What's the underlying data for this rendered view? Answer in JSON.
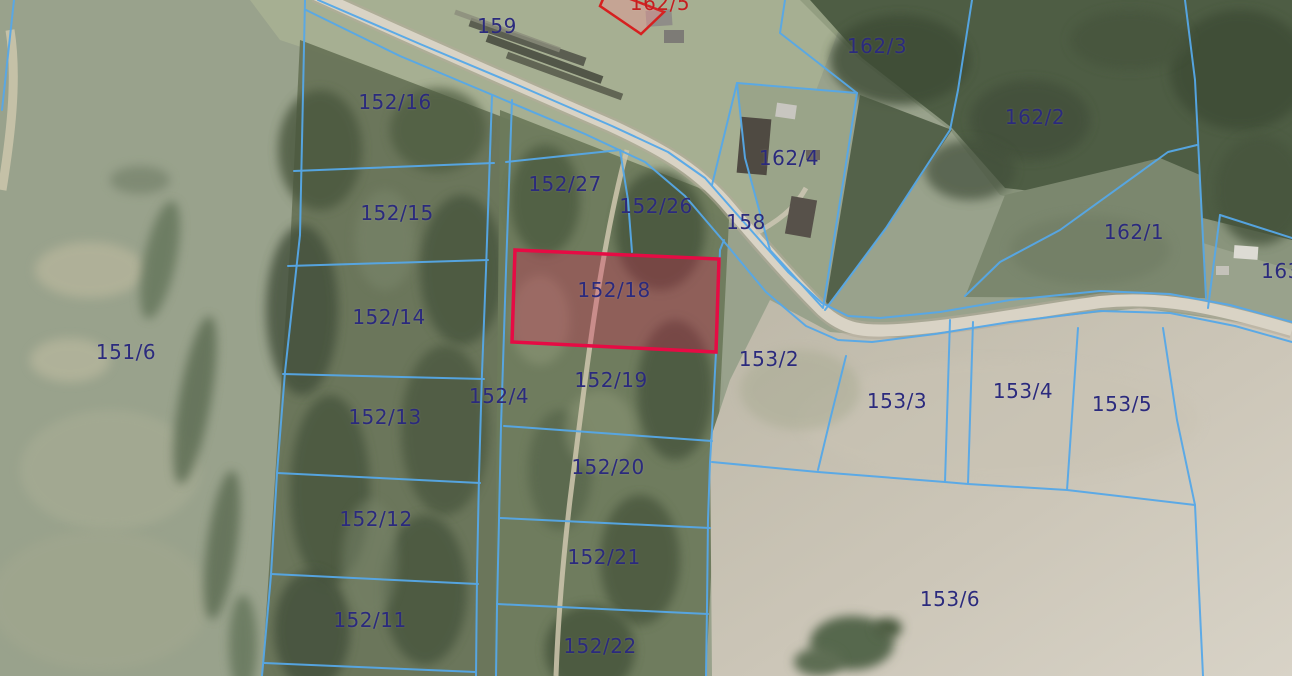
{
  "map": {
    "type": "cadastral-parcel-map",
    "colors": {
      "boundary_line": "#56a8e8",
      "label_navy": "#2b2a7d",
      "label_red": "#c41f1f",
      "highlight_stroke": "#e60b44",
      "highlight_fill": "rgba(225,20,80,0.28)",
      "flag_stroke": "#d62020",
      "flag_fill": "rgba(235,150,150,0.45)"
    },
    "highlighted_parcel": {
      "id": "152/18"
    },
    "flagged_parcel": {
      "id": "162/5"
    },
    "labels": [
      {
        "text": "159",
        "x": 497,
        "y": 26
      },
      {
        "text": "162/5",
        "x": 660,
        "y": 3,
        "color": "#c41f1f"
      },
      {
        "text": "162/3",
        "x": 877,
        "y": 46
      },
      {
        "text": "162/2",
        "x": 1035,
        "y": 117
      },
      {
        "text": "162/4",
        "x": 789,
        "y": 158
      },
      {
        "text": "158",
        "x": 746,
        "y": 222
      },
      {
        "text": "162/1",
        "x": 1134,
        "y": 232
      },
      {
        "text": "163",
        "x": 1281,
        "y": 271
      },
      {
        "text": "152/16",
        "x": 395,
        "y": 102
      },
      {
        "text": "152/27",
        "x": 565,
        "y": 184
      },
      {
        "text": "152/26",
        "x": 656,
        "y": 206
      },
      {
        "text": "152/15",
        "x": 397,
        "y": 213
      },
      {
        "text": "152/14",
        "x": 389,
        "y": 317
      },
      {
        "text": "151/6",
        "x": 126,
        "y": 352
      },
      {
        "text": "152/18",
        "x": 614,
        "y": 290
      },
      {
        "text": "153/2",
        "x": 769,
        "y": 359
      },
      {
        "text": "152/4",
        "x": 499,
        "y": 396
      },
      {
        "text": "152/19",
        "x": 611,
        "y": 380
      },
      {
        "text": "153/3",
        "x": 897,
        "y": 401
      },
      {
        "text": "153/4",
        "x": 1023,
        "y": 391
      },
      {
        "text": "153/5",
        "x": 1122,
        "y": 404
      },
      {
        "text": "152/13",
        "x": 385,
        "y": 417
      },
      {
        "text": "152/20",
        "x": 608,
        "y": 467
      },
      {
        "text": "152/12",
        "x": 376,
        "y": 519
      },
      {
        "text": "152/21",
        "x": 604,
        "y": 557
      },
      {
        "text": "153/6",
        "x": 950,
        "y": 599
      },
      {
        "text": "152/11",
        "x": 370,
        "y": 620
      },
      {
        "text": "152/22",
        "x": 600,
        "y": 646
      }
    ]
  }
}
